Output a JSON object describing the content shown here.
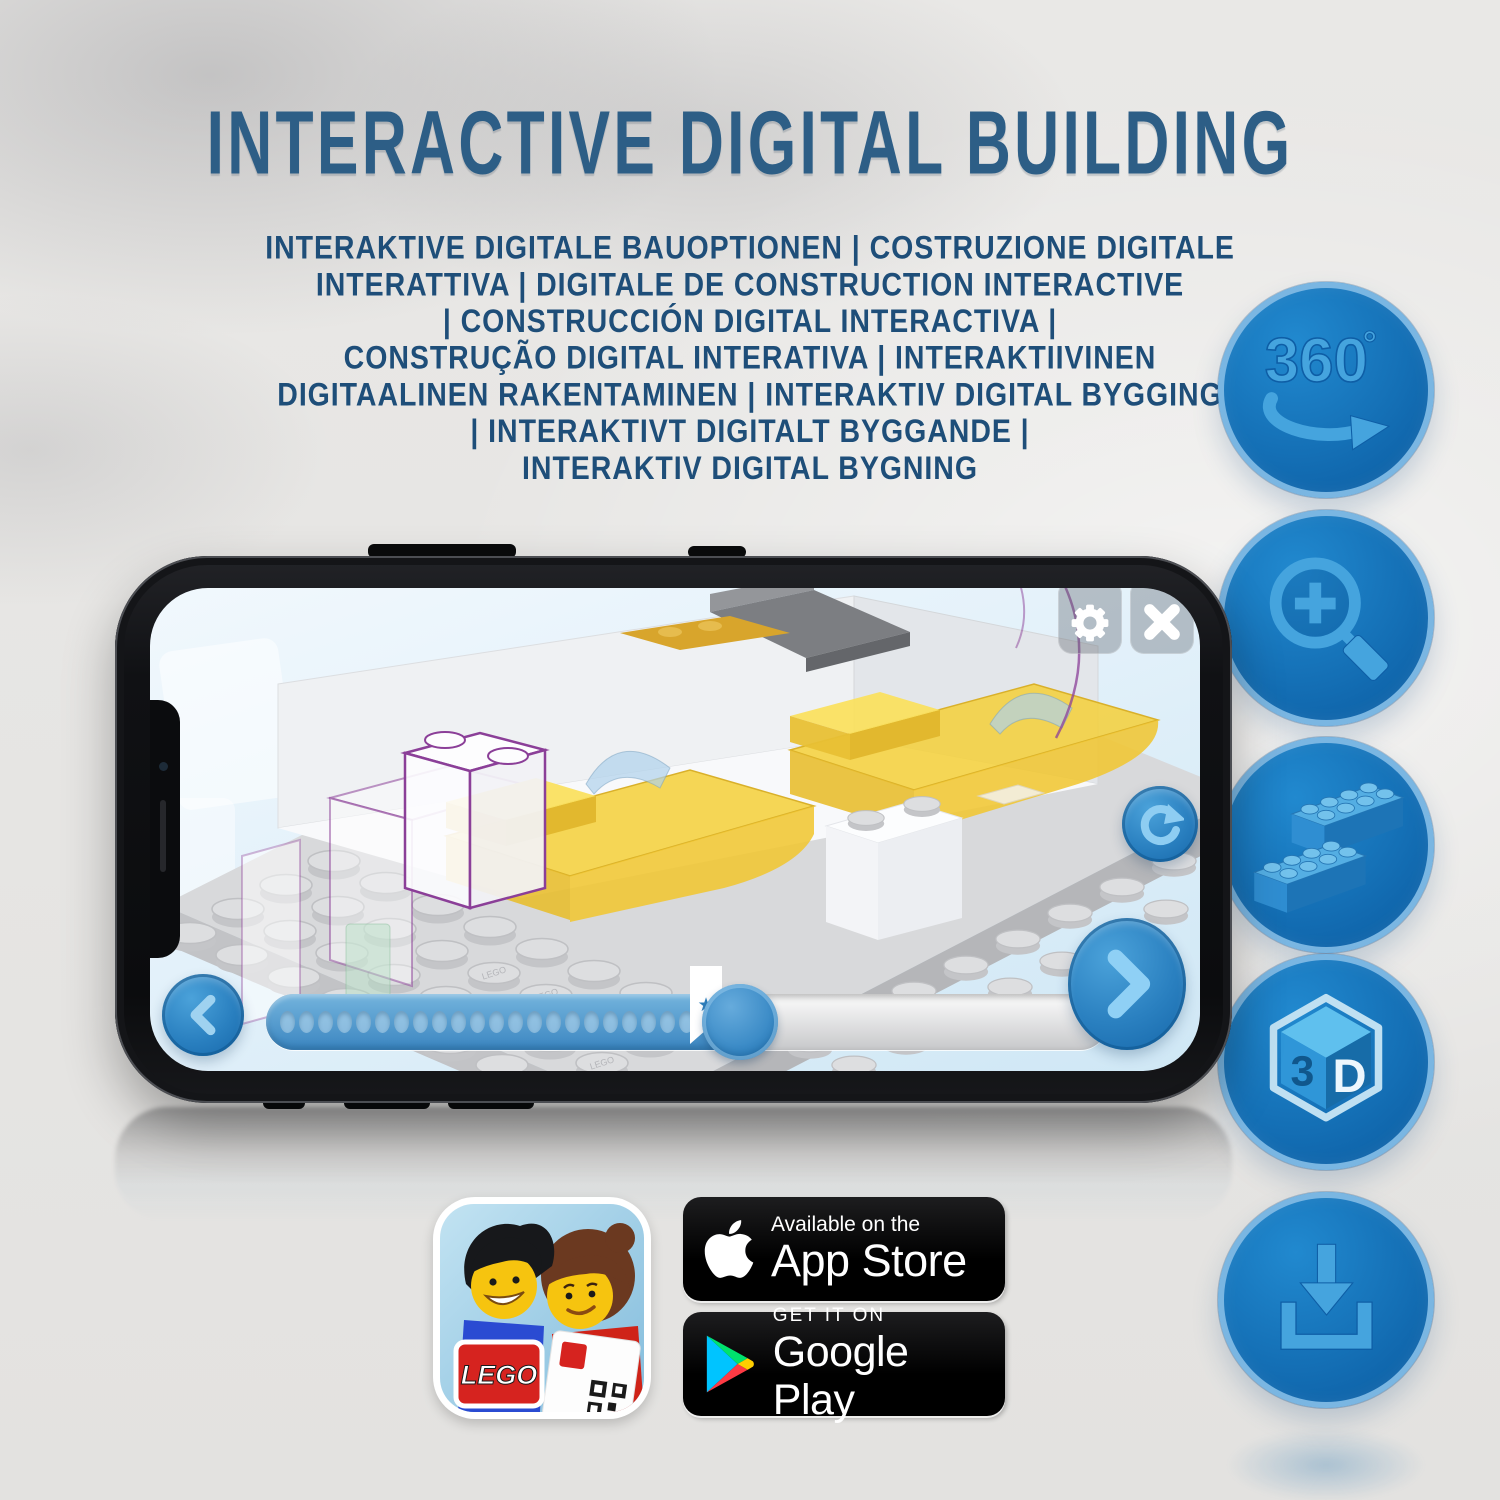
{
  "header": {
    "title": "INTERACTIVE DIGITAL BUILDING"
  },
  "subtitle": {
    "lines": [
      "INTERAKTIVE DIGITALE BAUOPTIONEN | COSTRUZIONE DIGITALE",
      "INTERATTIVA | DIGITALE DE CONSTRUCTION INTERACTIVE",
      "| CONSTRUCCIÓN DIGITAL INTERACTIVA |",
      "CONSTRUÇÃO DIGITAL INTERATIVA | INTERAKTIIVINEN",
      "DIGITAALINEN RAKENTAMINEN | INTERAKTIV DIGITAL BYGGING",
      "| INTERAKTIVT DIGITALT BYGGANDE |",
      "INTERAKTIV DIGITAL BYGNING"
    ]
  },
  "features": {
    "rotate": {
      "number": "360",
      "degree": "°"
    },
    "cube": {
      "left": "3",
      "right": "D"
    }
  },
  "phone": {
    "stud_label": "LEGO",
    "bookmark_star": "★"
  },
  "app_icon": {
    "logo_text": "LEGO"
  },
  "badges": {
    "app_store": {
      "line1": "Available on the",
      "line2": "App Store"
    },
    "google_play": {
      "line1": "GET IT ON",
      "line2": "Google Play"
    }
  },
  "colors": {
    "accent_blue": "#1173b9",
    "glyph_blue": "#45a4de",
    "title_blue": "#2d5e86",
    "body_text_blue": "#1e4e79",
    "bed_yellow": "#f2cf45",
    "ghost_purple": "#8b3f98",
    "badge_black": "#000000"
  }
}
